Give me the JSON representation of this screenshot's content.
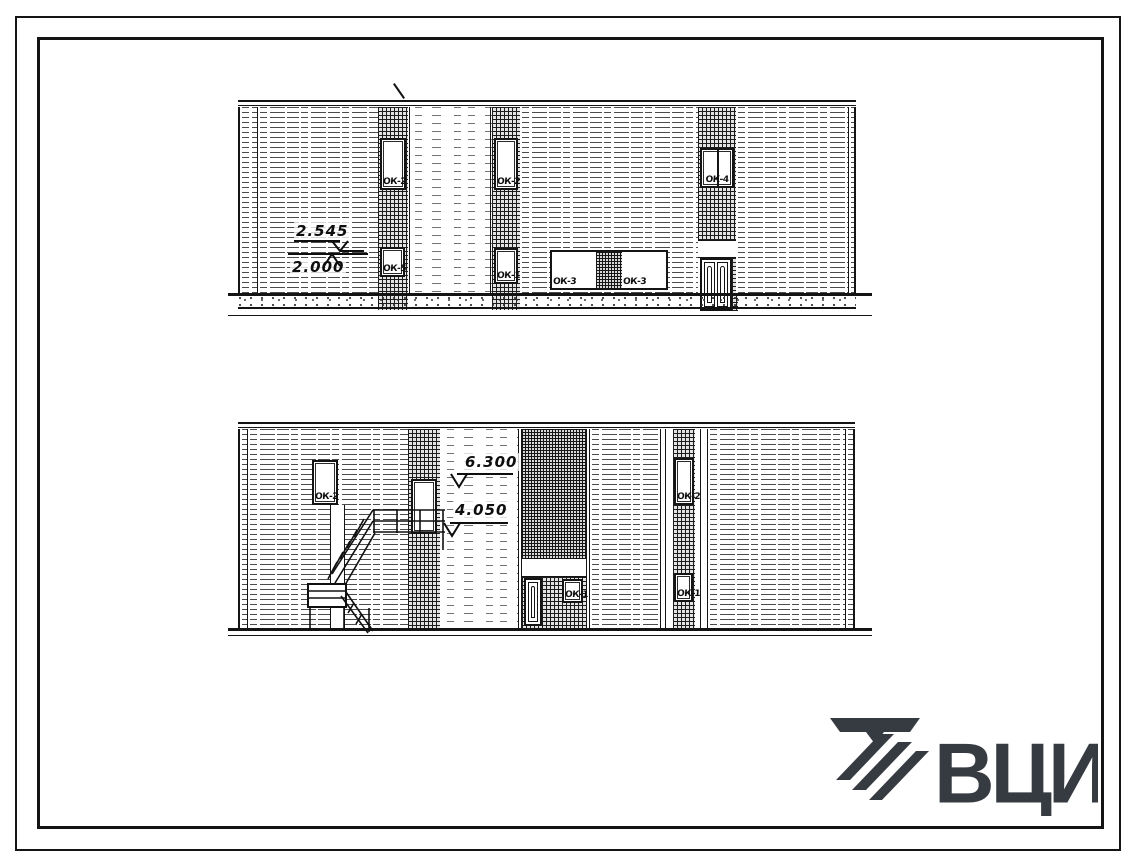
{
  "document": {
    "kind": "Scanned architectural drawing — building elevations (typical Soviet design sheet)",
    "ink_color": "#141414",
    "paper_color": "#ffffff"
  },
  "top_elevation": {
    "name": "main-facade-elevation",
    "levels": [
      {
        "value": "2.545"
      },
      {
        "value": "2.000"
      }
    ],
    "windows": {
      "strip_a_upper": "ОК-2",
      "strip_a_lower": "ОК-5",
      "strip_b_upper": "ОК-2",
      "strip_b_lower": "ОК-1",
      "mid_left": "ОК-3",
      "mid_right": "ОК-3",
      "right_pair": "ОК-4"
    }
  },
  "bottom_elevation": {
    "name": "end-facade-elevation-with-fire-escape",
    "levels": [
      {
        "value": "6.300"
      },
      {
        "value": "4.050"
      }
    ],
    "windows": {
      "left_wall": "ОК-2",
      "entrance": "ОК-1",
      "strip_upper": "ОК-2",
      "strip_lower": "ОК-1"
    }
  },
  "logo": {
    "text": "ВЦИС",
    "color": "#363b42"
  }
}
